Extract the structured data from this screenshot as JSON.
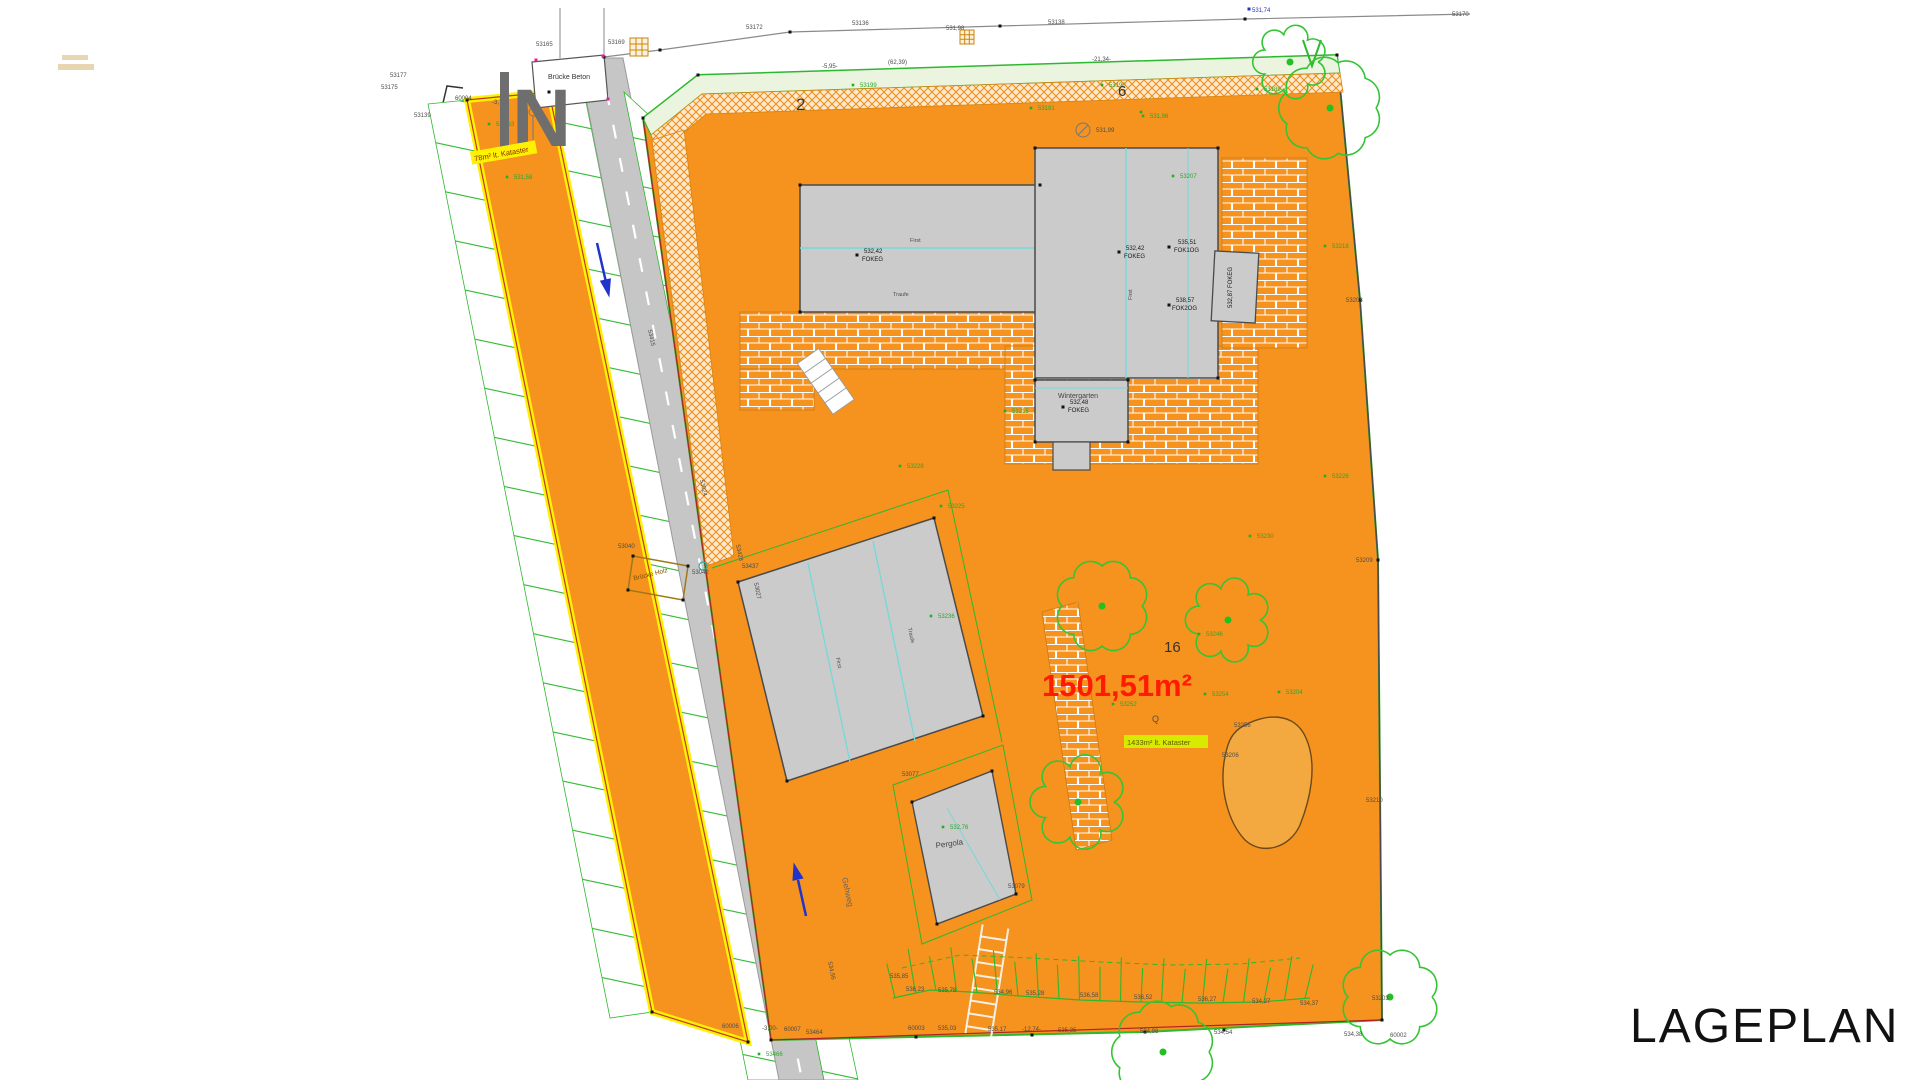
{
  "title": {
    "text": "LAGEPLAN"
  },
  "parcel": {
    "area_text": "1501,51m²",
    "number": "16"
  },
  "neighbors": {
    "left": "2",
    "right": "6"
  },
  "annotations": {
    "north": "N",
    "bruecke_beton": "Brücke Beton",
    "bruecke_holz": "Brücke Holz",
    "kataster_strip": "78m² lt. Kataster",
    "kataster_main": "1433m² lt. Kataster",
    "wintergarten": "Wintergarten",
    "pergola": "Pergola",
    "gehweg": "Gehweg"
  },
  "colors": {
    "parcel_orange": "#F6921E",
    "boundary_yellow": "#FFF200",
    "line_green": "#2DB82D",
    "area_red": "#FF1A00",
    "ridge_cyan": "#74D9D9",
    "building_gray": "#CBCBCB",
    "road_gray": "#C6C6C6",
    "north_gray": "#6E6E6E",
    "highlight_yellowgreen": "#D8EA00"
  },
  "labels": [
    {
      "t": "53172",
      "x": 746,
      "y": 29
    },
    {
      "t": "53136",
      "x": 852,
      "y": 25
    },
    {
      "t": "531,98",
      "x": 946,
      "y": 30
    },
    {
      "t": "53138",
      "x": 1048,
      "y": 24
    },
    {
      "t": "531,74",
      "x": 1252,
      "y": 12,
      "c": "bl"
    },
    {
      "t": "53170",
      "x": 1452,
      "y": 16
    },
    {
      "t": "53165",
      "x": 536,
      "y": 46
    },
    {
      "t": "53169",
      "x": 608,
      "y": 44
    },
    {
      "t": "53177",
      "x": 390,
      "y": 77
    },
    {
      "t": "53175",
      "x": 381,
      "y": 89
    },
    {
      "t": "53139",
      "x": 414,
      "y": 117
    },
    {
      "t": "60004",
      "x": 455,
      "y": 100
    },
    {
      "t": "-3,76-",
      "x": 492,
      "y": 104
    },
    {
      "t": "531,63",
      "x": 496,
      "y": 126,
      "c": "gr"
    },
    {
      "t": "531,58",
      "x": 514,
      "y": 179,
      "c": "gr"
    },
    {
      "t": "-5,95-",
      "x": 822,
      "y": 68
    },
    {
      "t": "(62,39)",
      "x": 888,
      "y": 64
    },
    {
      "t": "-21,34-",
      "x": 1092,
      "y": 61
    },
    {
      "t": "531,99",
      "x": 1096,
      "y": 132
    },
    {
      "t": "53199",
      "x": 860,
      "y": 87,
      "c": "gr"
    },
    {
      "t": "53190",
      "x": 1109,
      "y": 87,
      "c": "gr"
    },
    {
      "t": "53189",
      "x": 1264,
      "y": 91,
      "c": "gr"
    },
    {
      "t": "53191",
      "x": 1038,
      "y": 110,
      "c": "gr"
    },
    {
      "t": "531,96",
      "x": 1150,
      "y": 118,
      "c": "gr"
    },
    {
      "t": "53207",
      "x": 1180,
      "y": 178,
      "c": "gr"
    },
    {
      "t": "53218",
      "x": 1332,
      "y": 248,
      "c": "gr"
    },
    {
      "t": "53215",
      "x": 1012,
      "y": 413,
      "c": "gr"
    },
    {
      "t": "53226",
      "x": 1332,
      "y": 478,
      "c": "gr"
    },
    {
      "t": "53228",
      "x": 907,
      "y": 468,
      "c": "gr"
    },
    {
      "t": "53230",
      "x": 1257,
      "y": 538,
      "c": "gr"
    },
    {
      "t": "53236",
      "x": 938,
      "y": 618,
      "c": "gr"
    },
    {
      "t": "53225",
      "x": 948,
      "y": 508,
      "c": "gr"
    },
    {
      "t": "53246",
      "x": 1206,
      "y": 636,
      "c": "gr"
    },
    {
      "t": "53252",
      "x": 1120,
      "y": 706,
      "c": "gr"
    },
    {
      "t": "53254",
      "x": 1212,
      "y": 696,
      "c": "gr"
    },
    {
      "t": "53204",
      "x": 1286,
      "y": 694,
      "c": "gr"
    },
    {
      "t": "53256",
      "x": 1234,
      "y": 727
    },
    {
      "t": "53206",
      "x": 1222,
      "y": 757
    },
    {
      "t": "Q",
      "x": 1152,
      "y": 722,
      "s": 9
    },
    {
      "t": "53208",
      "x": 1346,
      "y": 302
    },
    {
      "t": "53209",
      "x": 1356,
      "y": 562
    },
    {
      "t": "53210",
      "x": 1366,
      "y": 802
    },
    {
      "t": "53203",
      "x": 1372,
      "y": 1000
    },
    {
      "t": "60006",
      "x": 722,
      "y": 1028
    },
    {
      "t": "-3,00-",
      "x": 762,
      "y": 1030
    },
    {
      "t": "60007",
      "x": 784,
      "y": 1031
    },
    {
      "t": "53464",
      "x": 806,
      "y": 1034
    },
    {
      "t": "60003",
      "x": 908,
      "y": 1030
    },
    {
      "t": "535,03",
      "x": 938,
      "y": 1030
    },
    {
      "t": "535,17",
      "x": 988,
      "y": 1031
    },
    {
      "t": "-12,74-",
      "x": 1022,
      "y": 1031
    },
    {
      "t": "535,35",
      "x": 1058,
      "y": 1032
    },
    {
      "t": "534,98",
      "x": 1140,
      "y": 1033
    },
    {
      "t": "534,54",
      "x": 1214,
      "y": 1034
    },
    {
      "t": "534,38",
      "x": 1344,
      "y": 1036
    },
    {
      "t": "60002",
      "x": 1390,
      "y": 1037
    },
    {
      "t": "53466",
      "x": 766,
      "y": 1056,
      "c": "gr"
    },
    {
      "t": "535,85",
      "x": 890,
      "y": 978
    },
    {
      "t": "536,23",
      "x": 906,
      "y": 991
    },
    {
      "t": "535,78",
      "x": 938,
      "y": 992
    },
    {
      "t": "534,96",
      "x": 994,
      "y": 994
    },
    {
      "t": "535,28",
      "x": 1026,
      "y": 995
    },
    {
      "t": "536,58",
      "x": 1080,
      "y": 997
    },
    {
      "t": "536,52",
      "x": 1134,
      "y": 999
    },
    {
      "t": "536,27",
      "x": 1198,
      "y": 1001
    },
    {
      "t": "534,27",
      "x": 1252,
      "y": 1003
    },
    {
      "t": "534,37",
      "x": 1300,
      "y": 1005
    },
    {
      "t": "53428",
      "x": 736,
      "y": 545,
      "r": 78
    },
    {
      "t": "53027",
      "x": 754,
      "y": 583,
      "r": 78
    },
    {
      "t": "53024",
      "x": 700,
      "y": 480,
      "r": 78
    },
    {
      "t": "534,56",
      "x": 828,
      "y": 962,
      "r": 78
    },
    {
      "t": "53415",
      "x": 648,
      "y": 330,
      "r": 78
    },
    {
      "t": "53040",
      "x": 618,
      "y": 548
    },
    {
      "t": "53042",
      "x": 692,
      "y": 574
    },
    {
      "t": "532,42",
      "x": 864,
      "y": 253,
      "c": "bk"
    },
    {
      "t": "FOKEG",
      "x": 862,
      "y": 261,
      "c": "bk"
    },
    {
      "t": "532,42",
      "x": 1126,
      "y": 250,
      "c": "bk"
    },
    {
      "t": "FOKEG",
      "x": 1124,
      "y": 258,
      "c": "bk"
    },
    {
      "t": "535,51",
      "x": 1178,
      "y": 244,
      "c": "bk"
    },
    {
      "t": "FOK1OG",
      "x": 1174,
      "y": 252,
      "c": "bk"
    },
    {
      "t": "538,57",
      "x": 1176,
      "y": 302,
      "c": "bk"
    },
    {
      "t": "FOK2OG",
      "x": 1172,
      "y": 310,
      "c": "bk"
    },
    {
      "t": "532,48",
      "x": 1070,
      "y": 404,
      "c": "bk"
    },
    {
      "t": "FOKEG",
      "x": 1068,
      "y": 412,
      "c": "bk"
    },
    {
      "t": "532,87 FOKEG",
      "x": 1232,
      "y": 308,
      "c": "bk",
      "r": -90
    },
    {
      "t": "First",
      "x": 910,
      "y": 242,
      "s": 5.5
    },
    {
      "t": "Traufe",
      "x": 893,
      "y": 296,
      "s": 5.5
    },
    {
      "t": "First",
      "x": 1132,
      "y": 300,
      "s": 5.5,
      "r": -90
    },
    {
      "t": "First",
      "x": 836,
      "y": 658,
      "s": 5.5,
      "r": 78
    },
    {
      "t": "Traufe",
      "x": 908,
      "y": 628,
      "s": 5.5,
      "r": 78
    },
    {
      "t": "532,76",
      "x": 950,
      "y": 829,
      "c": "gr"
    },
    {
      "t": "53077",
      "x": 902,
      "y": 776
    },
    {
      "t": "53079",
      "x": 1008,
      "y": 888
    },
    {
      "t": "53437",
      "x": 742,
      "y": 568
    }
  ],
  "points": [
    {
      "x": 643,
      "y": 118,
      "c": "k"
    },
    {
      "x": 698,
      "y": 75,
      "c": "k"
    },
    {
      "x": 1337,
      "y": 55,
      "c": "k"
    },
    {
      "x": 1360,
      "y": 300,
      "c": "k"
    },
    {
      "x": 1378,
      "y": 560,
      "c": "k"
    },
    {
      "x": 1382,
      "y": 1020,
      "c": "k"
    },
    {
      "x": 1145,
      "y": 1032,
      "c": "k"
    },
    {
      "x": 771,
      "y": 1040,
      "c": "k"
    },
    {
      "x": 652,
      "y": 1012,
      "c": "k"
    },
    {
      "x": 748,
      "y": 1042,
      "c": "k"
    },
    {
      "x": 467,
      "y": 100,
      "c": "k"
    },
    {
      "x": 549,
      "y": 92,
      "c": "k"
    },
    {
      "x": 800,
      "y": 185,
      "c": "k"
    },
    {
      "x": 1040,
      "y": 185,
      "c": "k"
    },
    {
      "x": 1035,
      "y": 148,
      "c": "k"
    },
    {
      "x": 1218,
      "y": 148,
      "c": "k"
    },
    {
      "x": 1218,
      "y": 378,
      "c": "k"
    },
    {
      "x": 1128,
      "y": 442,
      "c": "k"
    },
    {
      "x": 1035,
      "y": 442,
      "c": "k"
    },
    {
      "x": 800,
      "y": 312,
      "c": "k"
    },
    {
      "x": 1035,
      "y": 380,
      "c": "k"
    },
    {
      "x": 1128,
      "y": 380,
      "c": "k"
    },
    {
      "x": 738,
      "y": 582,
      "c": "k"
    },
    {
      "x": 934,
      "y": 518,
      "c": "k"
    },
    {
      "x": 983,
      "y": 716,
      "c": "k"
    },
    {
      "x": 787,
      "y": 781,
      "c": "k"
    },
    {
      "x": 912,
      "y": 802,
      "c": "k"
    },
    {
      "x": 992,
      "y": 771,
      "c": "k"
    },
    {
      "x": 1016,
      "y": 894,
      "c": "k"
    },
    {
      "x": 937,
      "y": 924,
      "c": "k"
    },
    {
      "x": 633,
      "y": 556,
      "c": "k"
    },
    {
      "x": 688,
      "y": 566,
      "c": "k"
    },
    {
      "x": 683,
      "y": 600,
      "c": "k"
    },
    {
      "x": 628,
      "y": 590,
      "c": "k"
    },
    {
      "x": 916,
      "y": 1037,
      "c": "k"
    },
    {
      "x": 1032,
      "y": 1035,
      "c": "k"
    },
    {
      "x": 1224,
      "y": 1030,
      "c": "k"
    },
    {
      "x": 857,
      "y": 255,
      "c": "k"
    },
    {
      "x": 1119,
      "y": 252,
      "c": "k"
    },
    {
      "x": 1169,
      "y": 247,
      "c": "k"
    },
    {
      "x": 1169,
      "y": 305,
      "c": "k"
    },
    {
      "x": 1063,
      "y": 407,
      "c": "k"
    },
    {
      "x": 790,
      "y": 32,
      "c": "k"
    },
    {
      "x": 1000,
      "y": 26,
      "c": "k"
    },
    {
      "x": 1245,
      "y": 19,
      "c": "k"
    },
    {
      "x": 604,
      "y": 57,
      "c": "k"
    },
    {
      "x": 660,
      "y": 50,
      "c": "k"
    },
    {
      "x": 1249,
      "y": 9,
      "c": "b"
    },
    {
      "x": 536,
      "y": 60,
      "c": "m"
    },
    {
      "x": 603,
      "y": 56,
      "c": "m"
    },
    {
      "x": 608,
      "y": 99,
      "c": "m"
    },
    {
      "x": 853,
      "y": 85,
      "c": "g"
    },
    {
      "x": 1102,
      "y": 85,
      "c": "g"
    },
    {
      "x": 1257,
      "y": 89,
      "c": "g"
    },
    {
      "x": 1031,
      "y": 108,
      "c": "g"
    },
    {
      "x": 1173,
      "y": 176,
      "c": "g"
    },
    {
      "x": 1325,
      "y": 246,
      "c": "g"
    },
    {
      "x": 1005,
      "y": 411,
      "c": "g"
    },
    {
      "x": 1325,
      "y": 476,
      "c": "g"
    },
    {
      "x": 900,
      "y": 466,
      "c": "g"
    },
    {
      "x": 1250,
      "y": 536,
      "c": "g"
    },
    {
      "x": 931,
      "y": 616,
      "c": "g"
    },
    {
      "x": 1199,
      "y": 634,
      "c": "g"
    },
    {
      "x": 1113,
      "y": 704,
      "c": "g"
    },
    {
      "x": 1205,
      "y": 694,
      "c": "g"
    },
    {
      "x": 1279,
      "y": 692,
      "c": "g"
    },
    {
      "x": 489,
      "y": 124,
      "c": "g"
    },
    {
      "x": 507,
      "y": 177,
      "c": "g"
    },
    {
      "x": 943,
      "y": 827,
      "c": "g"
    },
    {
      "x": 941,
      "y": 506,
      "c": "g"
    },
    {
      "x": 1143,
      "y": 116,
      "c": "g"
    },
    {
      "x": 759,
      "y": 1054,
      "c": "g"
    },
    {
      "x": 1141,
      "y": 112,
      "c": "g"
    }
  ],
  "trees": [
    {
      "x": 1102,
      "y": 606,
      "r": 40
    },
    {
      "x": 1228,
      "y": 620,
      "r": 32
    },
    {
      "x": 1078,
      "y": 802,
      "r": 36
    },
    {
      "x": 1330,
      "y": 108,
      "r": 46
    },
    {
      "x": 1290,
      "y": 62,
      "r": 28
    },
    {
      "x": 1163,
      "y": 1052,
      "r": 46
    },
    {
      "x": 1390,
      "y": 997,
      "r": 42
    }
  ]
}
